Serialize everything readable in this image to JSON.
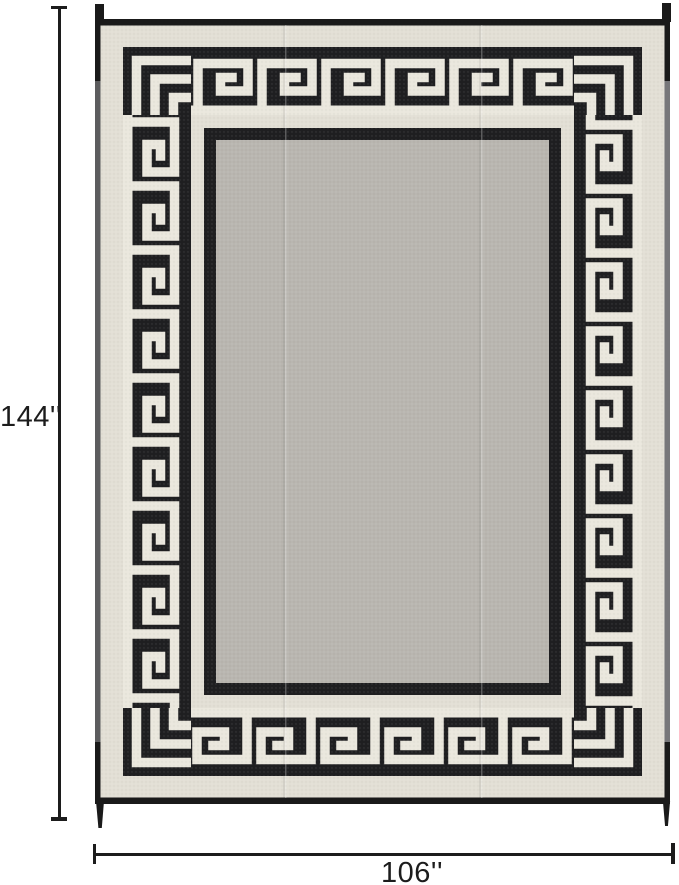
{
  "image": {
    "alt": "black and beige greek key border reversible outdoor patio mat with size annotations"
  },
  "annotations": {
    "height_label": "144''",
    "width_label": "106''",
    "line_color": "#1c1c1c"
  },
  "rug": {
    "pattern": "greek-key-border",
    "colors": {
      "page-bg": "#ffffff",
      "band-black": "#1f1f21",
      "beige": "#e2dfd5",
      "line": "#eae7dd",
      "field": "#b9b6b0",
      "binding": "#1a1a1a",
      "annotation": "#1c1c1c"
    }
  }
}
